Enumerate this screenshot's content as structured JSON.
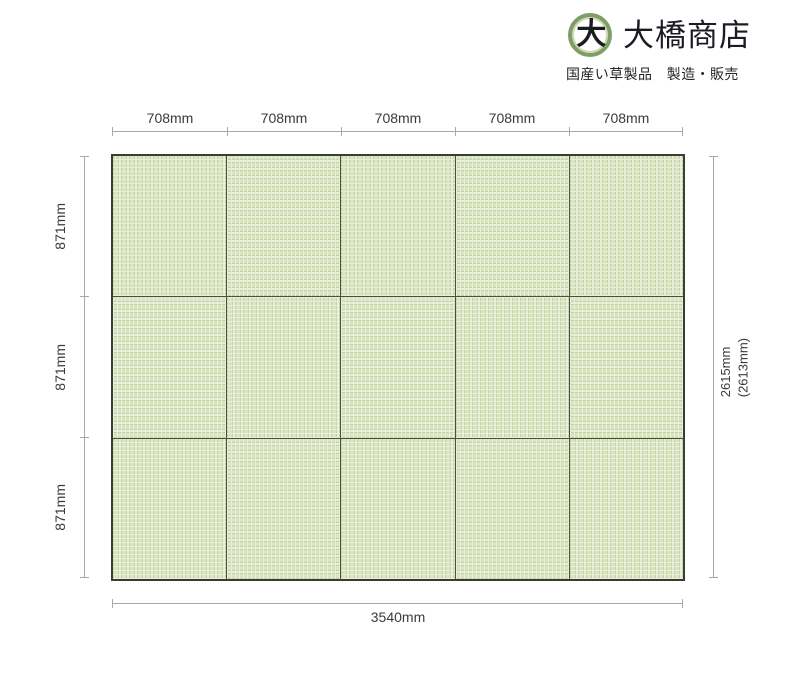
{
  "header": {
    "logo_mark_char": "大",
    "company_name": "大橋商店",
    "tagline": "国産い草製品　製造・販売"
  },
  "diagram": {
    "top_dimension_labels": [
      "708mm",
      "708mm",
      "708mm",
      "708mm",
      "708mm"
    ],
    "left_dimension_labels": [
      "871mm",
      "871mm",
      "871mm"
    ],
    "right_dimension_label": {
      "line1": "2615mm",
      "line2": "(2613mm)"
    },
    "bottom_dimension_label": "3540mm",
    "grid": {
      "rows": 3,
      "columns": 5
    },
    "mat_textures": [
      "weave-vertical",
      "weave-horizontal",
      "weave-vertical",
      "weave-horizontal",
      "weave-vertical",
      "weave-horizontal",
      "weave-vertical",
      "weave-horizontal",
      "weave-vertical",
      "weave-horizontal",
      "weave-vertical",
      "weave-horizontal",
      "weave-vertical",
      "weave-horizontal",
      "weave-vertical"
    ]
  },
  "colors": {
    "mat_base": "#e8eeda",
    "mat_weave": "#c2d49e",
    "mat_weave_light": "#d9e4c2",
    "mat_border": "#4b4e40",
    "grid_outer_border": "#3a3d31",
    "dimension_line": "#a8a8a8",
    "dimension_text": "#3a3a3a",
    "logo_ring": "#7f9d66",
    "logo_text": "#1b1b24"
  }
}
